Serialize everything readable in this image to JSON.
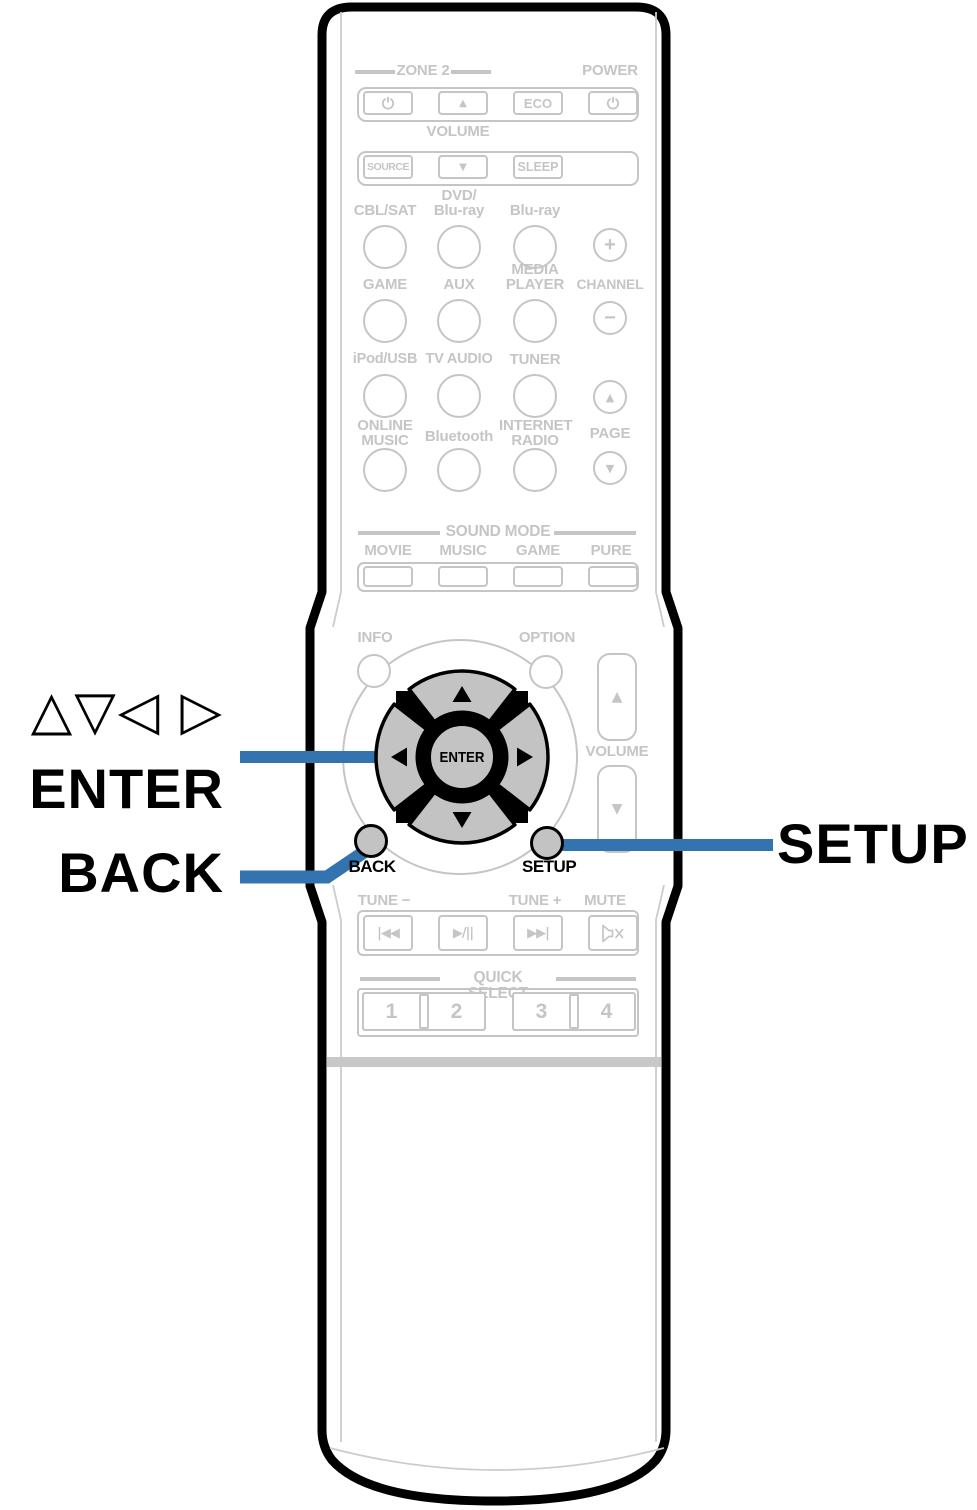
{
  "colors": {
    "callout_blue": "#3273b0",
    "print_gray": "#c5c5c5",
    "keypad_gray": "#c3c3c3",
    "outline_black": "#000000"
  },
  "callouts": {
    "cursor_symbols": "△▽◁ ▷",
    "enter": "ENTER",
    "back": "BACK",
    "setup": "SETUP"
  },
  "power_section": {
    "zone2_header": "ZONE 2",
    "power_header": "POWER",
    "zone2_up_icon": "▲",
    "eco": "ECO",
    "volume_header": "VOLUME",
    "source": "SOURCE",
    "volume_down_icon": "▼",
    "sleep": "SLEEP"
  },
  "source_grid": {
    "cbl_sat": "CBL/SAT",
    "dvd_bluray": "DVD/\nBlu-ray",
    "bluray": "Blu-ray",
    "channel_plus_icon": "+",
    "game": "GAME",
    "aux": "AUX",
    "media_player": "MEDIA\nPLAYER",
    "channel_header": "CHANNEL",
    "channel_minus_icon": "−",
    "ipod_usb": "iPod/USB",
    "tv_audio": "TV AUDIO",
    "tuner": "TUNER",
    "page_up_icon": "▲",
    "online_music": "ONLINE\nMUSIC",
    "bluetooth": "Bluetooth",
    "internet_radio": "INTERNET\nRADIO",
    "page_header": "PAGE",
    "page_down_icon": "▼"
  },
  "sound_mode": {
    "header": "SOUND MODE",
    "movie": "MOVIE",
    "music": "MUSIC",
    "game": "GAME",
    "pure": "PURE"
  },
  "keypad": {
    "info": "INFO",
    "option": "OPTION",
    "enter": "ENTER",
    "volume_header": "VOLUME",
    "volume_up_icon": "▲",
    "volume_down_icon": "▼",
    "back": "BACK",
    "setup": "SETUP"
  },
  "transport": {
    "tune_minus": "TUNE −",
    "tune_plus": "TUNE +",
    "mute": "MUTE",
    "skip_back_icon": "|◀◀",
    "play_pause_icon": "▶/||",
    "skip_forward_icon": "▶▶|"
  },
  "quick_select": {
    "header": "QUICK SELECT",
    "b1": "1",
    "b2": "2",
    "b3": "3",
    "b4": "4"
  }
}
